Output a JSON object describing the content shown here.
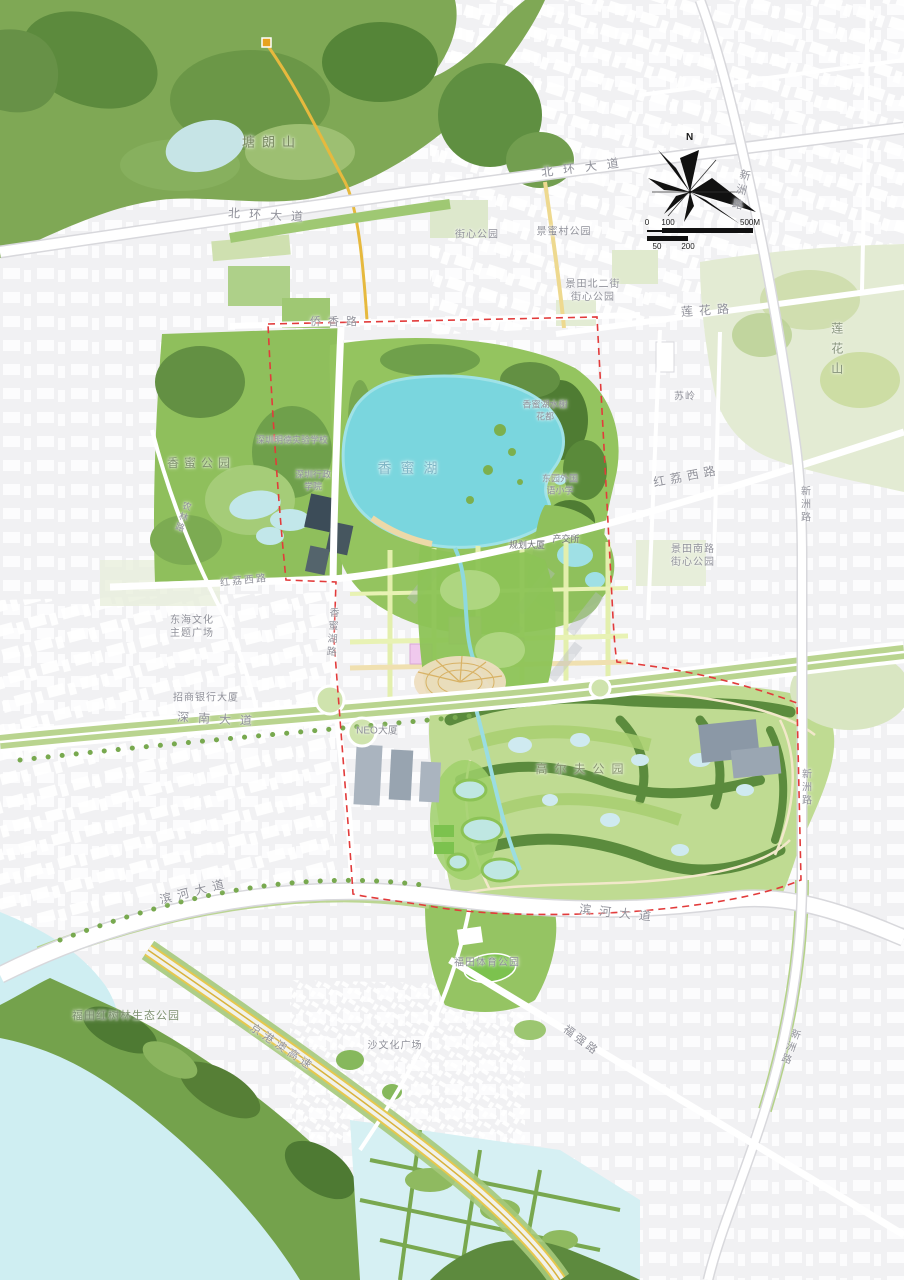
{
  "map": {
    "compass": {
      "north_label": "N"
    },
    "scalebar": {
      "ticks_top": [
        "0",
        "100",
        "500M"
      ],
      "ticks_bottom": [
        "50",
        "200"
      ]
    },
    "legend_colors": {
      "boundary_dash": "#e23b3b",
      "lake_water": "#7ad6de",
      "sea_water": "#cfeef2",
      "park_green": "#8fbf5c",
      "forest_green": "#55803a",
      "golf_green": "#bfdb92",
      "road_white": "#ffffff",
      "trail_yellow": "#e6b93e",
      "planned_block_pink": "#f0c9ed",
      "label_gray": "#90919a",
      "lake_label": "#7fb6c6"
    },
    "labels": [
      {
        "text": "塘朗山",
        "x": 272,
        "y": 143,
        "size": 13,
        "ls": 7,
        "color": "#77875f"
      },
      {
        "text": "北环大道",
        "x": 270,
        "y": 216,
        "size": 12,
        "ls": 9,
        "rot": 3
      },
      {
        "text": "北环大道",
        "x": 585,
        "y": 168,
        "size": 12,
        "ls": 10,
        "rot": -7
      },
      {
        "text": "街心公园",
        "x": 477,
        "y": 235,
        "size": 10,
        "ls": 1
      },
      {
        "text": "景蜜村公园",
        "x": 564,
        "y": 232,
        "size": 10,
        "ls": 1
      },
      {
        "lines": [
          "景田北二街",
          "街心公园"
        ],
        "x": 593,
        "y": 291,
        "size": 10,
        "ls": 1
      },
      {
        "text": "莲花路",
        "x": 708,
        "y": 311,
        "size": 12,
        "ls": 6,
        "rot": -4
      },
      {
        "text": "莲花山",
        "x": 836,
        "y": 352,
        "size": 12,
        "ls": 8,
        "vertical": true,
        "color": "#85927a"
      },
      {
        "text": "新洲路",
        "x": 740,
        "y": 191,
        "size": 11,
        "ls": 4,
        "vertical": true,
        "rot": 14
      },
      {
        "text": "苏岭",
        "x": 685,
        "y": 397,
        "size": 10,
        "ls": 1
      },
      {
        "text": "侨香路",
        "x": 337,
        "y": 322,
        "size": 11,
        "ls": 7
      },
      {
        "text": "香蜜公园",
        "x": 201,
        "y": 464,
        "size": 12,
        "ls": 5,
        "color": "#7d8f6b"
      },
      {
        "text": "深圳明德实验学校",
        "x": 292,
        "y": 441,
        "size": 9,
        "ls": 0
      },
      {
        "lines": [
          "深圳行政",
          "学院"
        ],
        "x": 313,
        "y": 481,
        "size": 9,
        "ls": 0
      },
      {
        "text": "香蜜湖",
        "x": 412,
        "y": 468,
        "size": 14,
        "ls": 9,
        "color": "#7fb6c6"
      },
      {
        "lines": [
          "香蜜湖水榭",
          "花都"
        ],
        "x": 545,
        "y": 411,
        "size": 9,
        "ls": 0
      },
      {
        "lines": [
          "东园外国",
          "语小学"
        ],
        "x": 560,
        "y": 485,
        "size": 9,
        "ls": 0
      },
      {
        "text": "红荔西路",
        "x": 687,
        "y": 477,
        "size": 12,
        "ls": 5,
        "rot": -11
      },
      {
        "lines": [
          "景田南路",
          "街心公园"
        ],
        "x": 693,
        "y": 556,
        "size": 10,
        "ls": 1
      },
      {
        "text": "新洲路",
        "x": 804,
        "y": 505,
        "size": 10,
        "ls": 3,
        "vertical": true
      },
      {
        "text": "新洲路",
        "x": 805,
        "y": 788,
        "size": 10,
        "ls": 3,
        "vertical": true
      },
      {
        "text": "新洲路",
        "x": 789,
        "y": 1047,
        "size": 10,
        "ls": 3,
        "vertical": true,
        "rot": 20
      },
      {
        "text": "红荔西路",
        "x": 244,
        "y": 581,
        "size": 10,
        "ls": 2,
        "rot": -6
      },
      {
        "lines": [
          "东海文化",
          "主题广场"
        ],
        "x": 192,
        "y": 627,
        "size": 10,
        "ls": 1
      },
      {
        "text": "香蜜湖路",
        "x": 331,
        "y": 633,
        "size": 10,
        "ls": 3,
        "vertical": true,
        "rot": 4
      },
      {
        "text": "规划大厦",
        "x": 527,
        "y": 546,
        "size": 9,
        "ls": 0,
        "color": "#6f7076"
      },
      {
        "text": "产交所",
        "x": 566,
        "y": 540,
        "size": 9,
        "ls": 0,
        "color": "#6f7076"
      },
      {
        "text": "招商银行大厦",
        "x": 206,
        "y": 698,
        "size": 10,
        "ls": 1
      },
      {
        "text": "深南大道",
        "x": 219,
        "y": 720,
        "size": 12,
        "ls": 9,
        "rot": 3
      },
      {
        "text": "NEO大厦",
        "x": 377,
        "y": 731,
        "size": 10,
        "ls": 0
      },
      {
        "text": "高尔夫公园",
        "x": 583,
        "y": 770,
        "size": 12,
        "ls": 7,
        "color": "#87936f"
      },
      {
        "text": "滨河大道",
        "x": 195,
        "y": 892,
        "size": 12,
        "ls": 6,
        "rot": -14
      },
      {
        "text": "滨河大道",
        "x": 619,
        "y": 914,
        "size": 12,
        "ls": 8,
        "rot": 6
      },
      {
        "text": "福田体育公园",
        "x": 487,
        "y": 963,
        "size": 10,
        "ls": 1
      },
      {
        "text": "福强路",
        "x": 581,
        "y": 1041,
        "size": 11,
        "ls": 3,
        "rot": 37
      },
      {
        "text": "京港澳高速",
        "x": 282,
        "y": 1048,
        "size": 11,
        "ls": 4,
        "rot": 34
      },
      {
        "text": "福田红树林生态公园",
        "x": 126,
        "y": 1016,
        "size": 11,
        "ls": 1,
        "color": "#7d9070"
      },
      {
        "text": "沙文化广场",
        "x": 395,
        "y": 1046,
        "size": 10,
        "ls": 1
      },
      {
        "text": "农林路",
        "x": 182,
        "y": 517,
        "size": 9,
        "ls": 2,
        "vertical": true,
        "rot": 18
      }
    ]
  }
}
